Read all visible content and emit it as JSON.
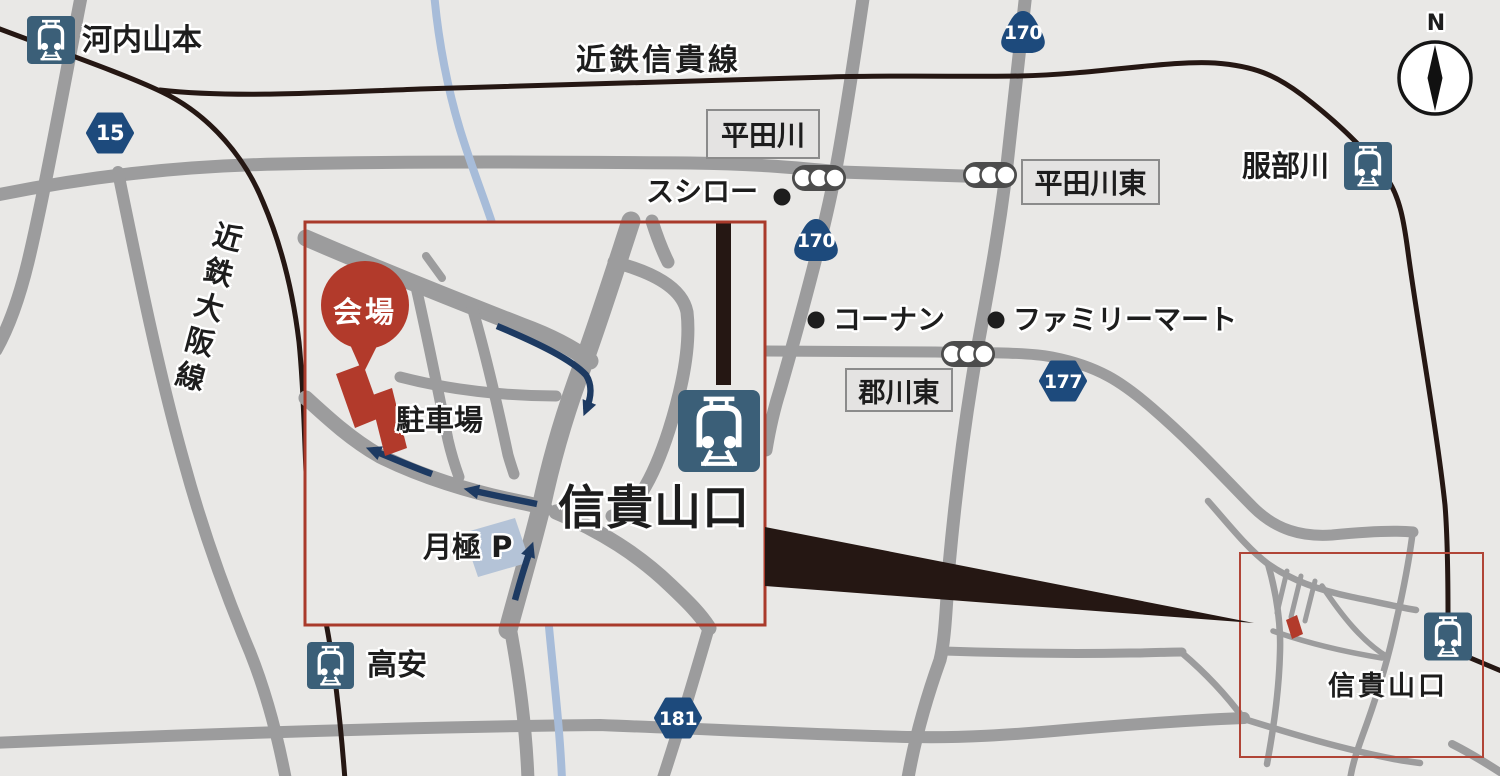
{
  "map_background": "#e9e8e6",
  "colors": {
    "road": "#9c9c9d",
    "railway": "#251713",
    "river": "#a7bcd9",
    "accent_red": "#b23a2b",
    "inset_border_red": "#a93a2b",
    "minimap_border_red": "#b04537",
    "route_arrow_navy": "#1d3a62",
    "shield_blue": "#1d4a7c",
    "station_icon_blue": "#3b5f78",
    "monthly_parking_fill": "#b4c3d7",
    "label_box_fill": "#e4e3e2"
  },
  "rail_lines": {
    "shigi": "近鉄信貴線",
    "osaka": "近鉄大阪線"
  },
  "stations": {
    "kawachi_yamamoto": "河内山本",
    "hattorigawa": "服部川",
    "takayasu": "高安",
    "shigisanguchi": "信貴山口",
    "shigisanguchi_mini": "信貴山口"
  },
  "intersections": {
    "hiratagawa": "平田川",
    "hiratagawa_higashi": "平田川東",
    "korigawa_higashi": "郡川東"
  },
  "pois": {
    "sushiro": "スシロー",
    "konan": "コーナン",
    "familymart": "ファミリーマート",
    "venue": "会場",
    "parking": "駐車場",
    "monthly_parking": "月極 P"
  },
  "route_shields": {
    "r15": "15",
    "r170_north": "170",
    "r170_mid": "170",
    "r177": "177",
    "r181": "181"
  },
  "compass_label": "N"
}
